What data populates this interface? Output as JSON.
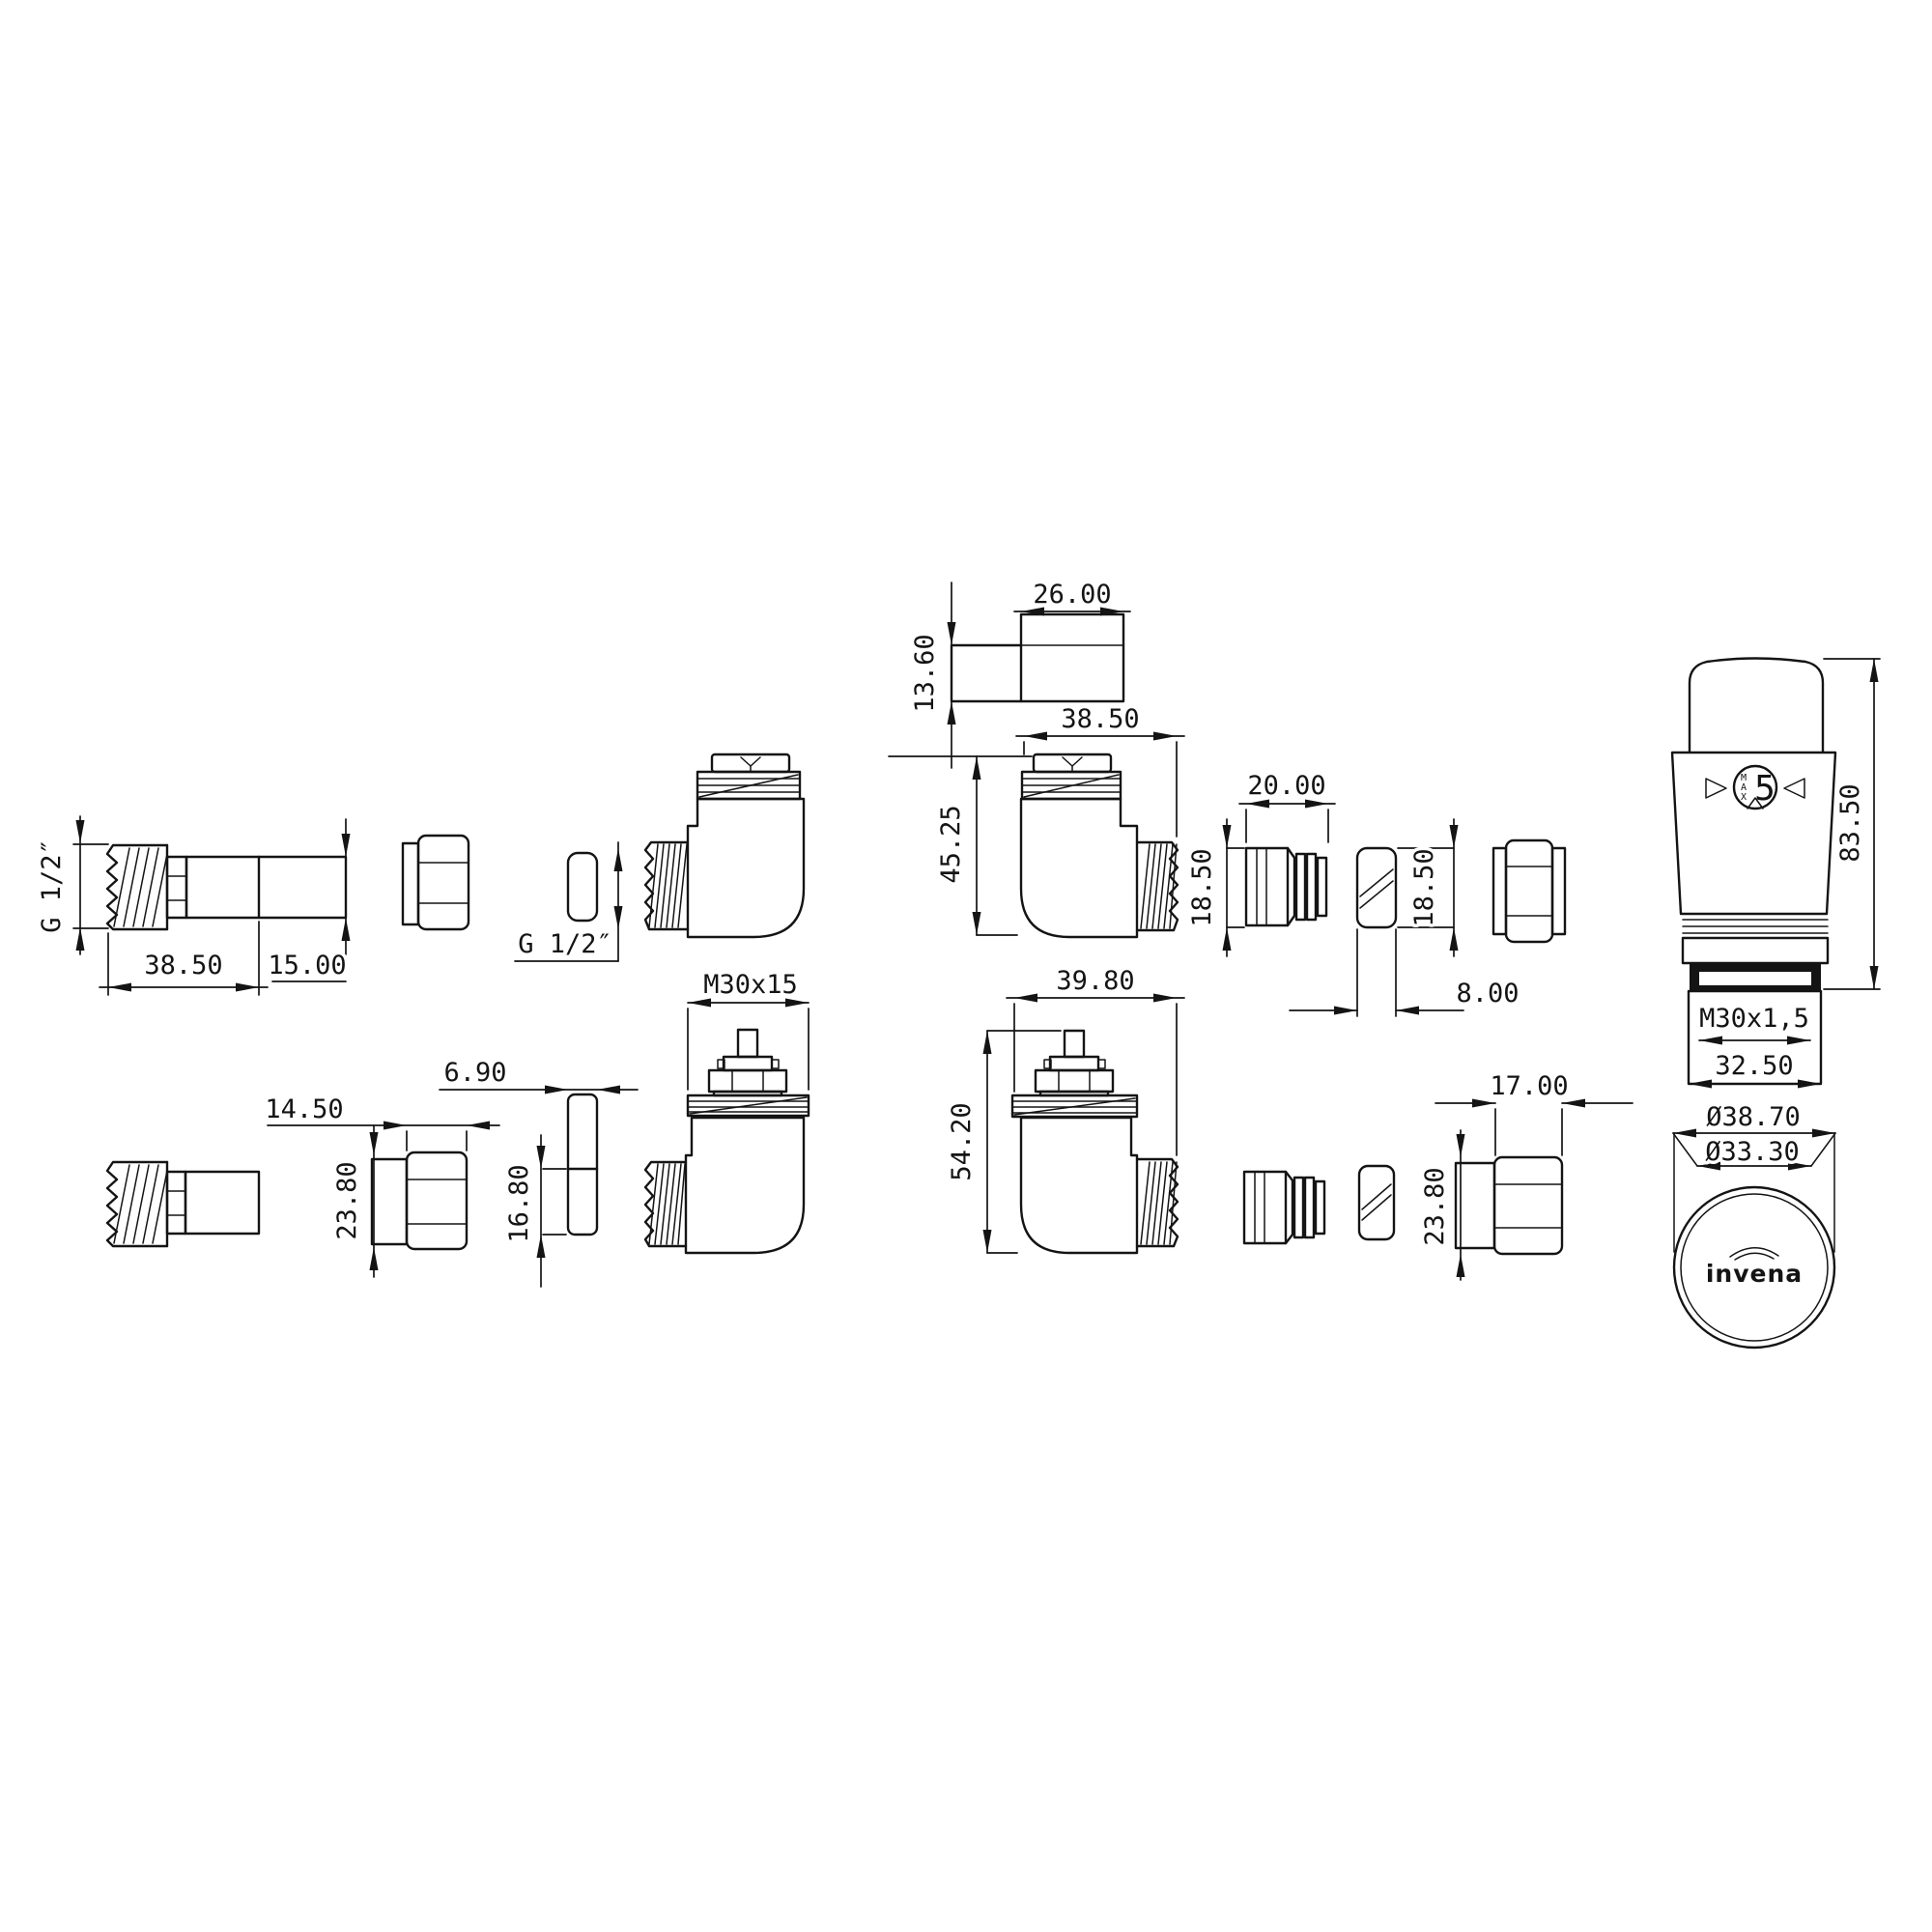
{
  "labels": {
    "brand": "invena",
    "dial_setting": "5",
    "dial_max": [
      "M",
      "A",
      "X"
    ]
  },
  "dims": {
    "tail_thread": "G 1/2″",
    "tail_length": "38.50",
    "tail_outlet": "15.00",
    "elbow_thread": "G 1/2″",
    "collar_thread": "M30x15",
    "nut_left_depth": "14.50",
    "nut_left_od": "23.80",
    "pin_width": "6.90",
    "pin_height": "16.80",
    "block_width": "26.00",
    "block_height": "13.60",
    "valve_top_width": "38.50",
    "valve_top_height": "45.25",
    "insert_width": "20.00",
    "insert_height": "18.50",
    "ring_height": "18.50",
    "ring_width": "8.00",
    "valve_bottom_width": "39.80",
    "valve_bottom_height": "54.20",
    "nut_right_depth": "17.00",
    "nut_right_od": "23.80",
    "head_height": "83.50",
    "head_thread": "M30x1,5",
    "head_width": "32.50",
    "head_outer_dia": "Ø38.70",
    "head_inner_dia": "Ø33.30"
  }
}
